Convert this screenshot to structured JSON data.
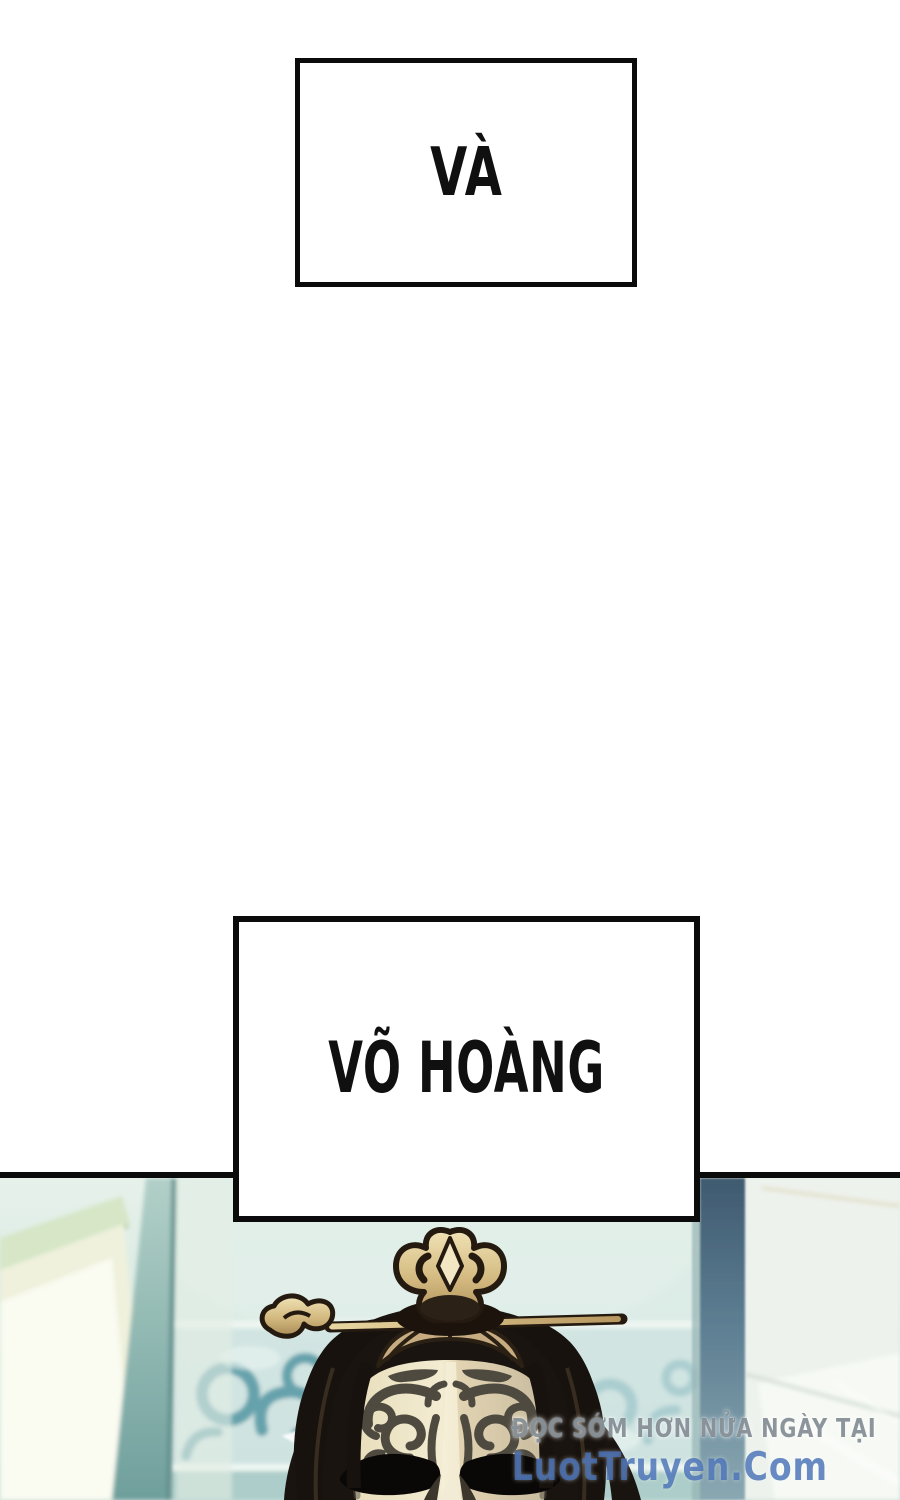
{
  "page": {
    "background": "#ffffff"
  },
  "captions": [
    {
      "text": "VÀ"
    },
    {
      "text": "VÕ HOÀNG"
    }
  ],
  "panel": {
    "watermark": {
      "line1": "ĐỌC SỚM HƠN NỬA NGÀY TẠI",
      "line2": "LuotTruyen.Com",
      "line1_color": "#80909a",
      "line2_color": "#4870b6"
    },
    "scene": {
      "subject": "masked figure with gold topknot crown and hairpin in blurred teal room",
      "colors": {
        "wall_teal": "#d5e7e0",
        "screen_cream": "#eff1dd",
        "screen_green_edge": "#d6e6c6",
        "screen_teal_strip": "#8fb9b2",
        "cloud_pattern_teal": "#66a2ac",
        "pillar_slate": "#51708a",
        "right_wall_pale": "#edf2ec",
        "hair_dark": "#17110c",
        "head_hair_tan": "#c6ac80",
        "mask_light": "#f0e8ce",
        "mask_shadow": "#c8bb9e",
        "mask_pattern": "#4f4a40",
        "eye_black": "#0a0806",
        "crown_gold": "#d3b97f",
        "crown_outline": "#241a10"
      }
    }
  }
}
